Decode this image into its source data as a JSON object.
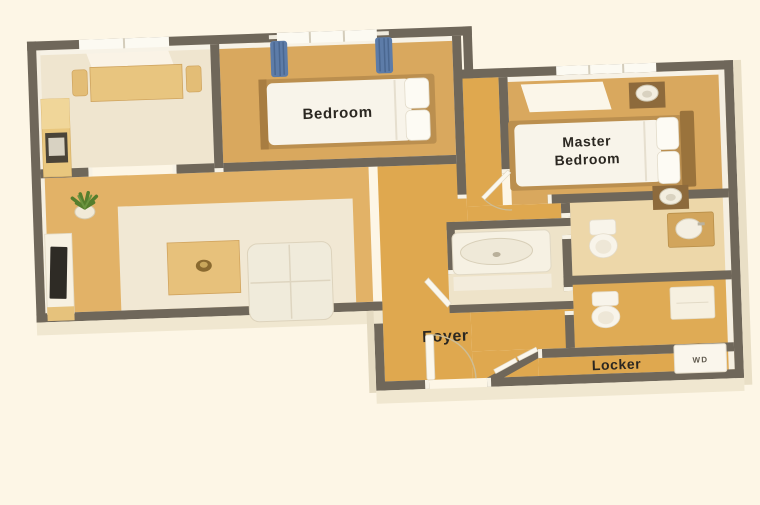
{
  "scene": {
    "background": "#fdf6e6",
    "wall_color": "#6f675a",
    "floor_wood": "#d9a85e",
    "floor_living": "#e2b267",
    "floor_gold": "#dfa84f",
    "floor_cream": "#efe5cf",
    "rug_cream": "#f1e8d4",
    "bath_floor": "#eee3c9",
    "toilet1_floor": "#edd7a9",
    "toilet2_floor": "#dfab55",
    "curtain_blue": "#5d7ca8",
    "bed_white": "#f8f4ea",
    "wood_frame": "#bb8f4f",
    "wood_dark": "#8d6a3c",
    "plant_green": "#557e2d",
    "tv_screen": "#2e2b25",
    "extrusion_cream": "#f0e7d0",
    "text_color": "#2b2721"
  },
  "labels": {
    "bedroom": "Bedroom",
    "master_line1": "Master",
    "master_line2": "Bedroom",
    "foyer": "Foyer",
    "locker": "Locker",
    "washer_dryer": "WD"
  },
  "rooms": [
    "dining-kitchen",
    "bedroom",
    "master-bedroom",
    "living-room",
    "foyer",
    "bathroom",
    "toilet-room-1",
    "toilet-room-2",
    "locker"
  ],
  "furniture": [
    "dining-table",
    "dining-chair",
    "kitchen-counter-sink",
    "window",
    "curtains",
    "single-bed",
    "double-bed",
    "nightstand",
    "table-lamp",
    "potted-plant",
    "tv-stand",
    "television",
    "coffee-table",
    "sofa",
    "bathtub",
    "toilet",
    "vanity-sink",
    "cabinet",
    "washer-dryer",
    "entry-door",
    "interior-door"
  ]
}
